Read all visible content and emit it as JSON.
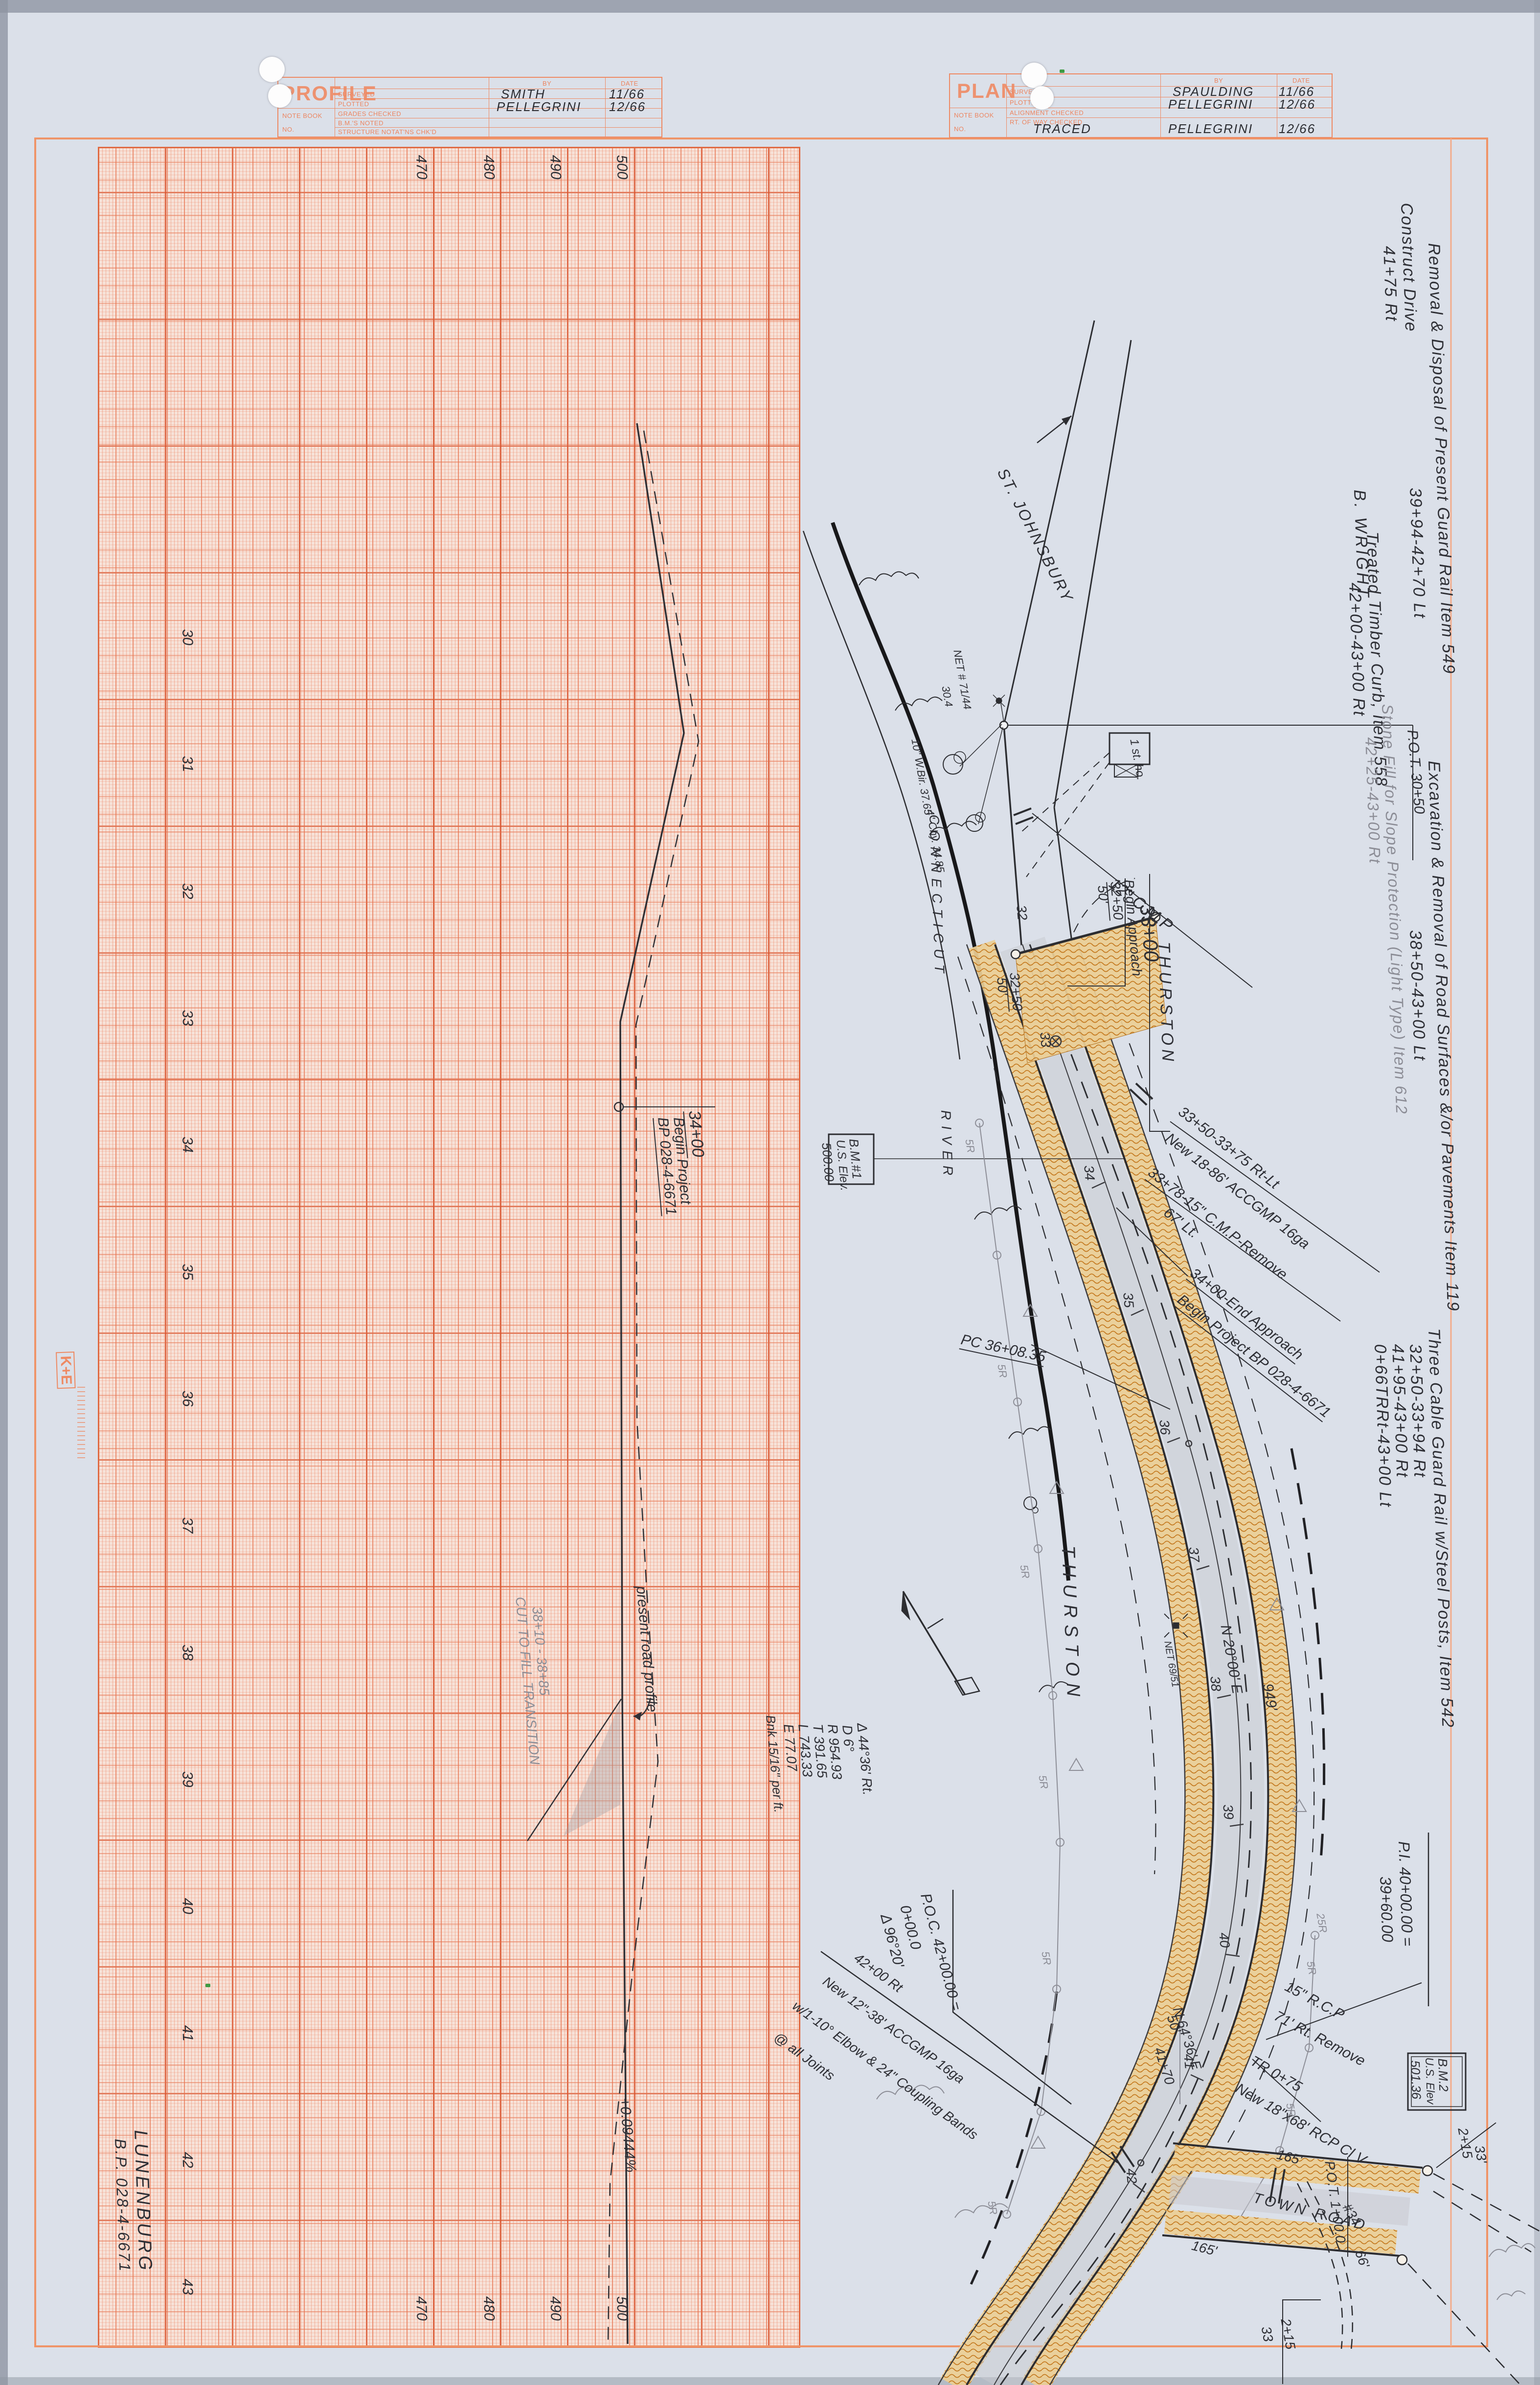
{
  "profile_block": {
    "title": "PROFILE",
    "note_book": "NOTE BOOK",
    "no_label": "NO.",
    "by": "BY",
    "date": "DATE",
    "row1": "SURVEYED",
    "row2": "PLOTTED",
    "row3": "GRADES CHECKED",
    "row4": "B.M.'S NOTED",
    "row5": "STRUCTURE NOTAT'NS CHK'D",
    "surveyed_by": "SMITH",
    "surveyed_date": "11/66",
    "plotted_by": "PELLEGRINI",
    "plotted_date": "12/66"
  },
  "plan_block": {
    "title": "PLAN",
    "note_book": "NOTE BOOK",
    "no_label": "NO.",
    "by": "BY",
    "date": "DATE",
    "row1": "SURVEYED",
    "row2": "PLOTTED",
    "row3": "ALIGNMENT CHECKED",
    "row4": "RT. OF WAY CHECKED",
    "surveyed_by": "SPAULDING",
    "surveyed_date": "11/66",
    "plotted_by": "PELLEGRINI",
    "plotted_date": "12/66",
    "traced_label": "TRACED",
    "traced_by": "PELLEGRINI",
    "traced_date": "12/66"
  },
  "profile": {
    "stations": [
      "30",
      "31",
      "32",
      "33",
      "34",
      "35",
      "36",
      "37",
      "38",
      "39",
      "40",
      "41",
      "42",
      "43"
    ],
    "elevations": [
      "470",
      "480",
      "490",
      "500"
    ],
    "begin_sta": "34+00",
    "begin_l1": "Begin Project",
    "begin_l2": "BP 028-4-6671",
    "cut_fill_l1": "38+10 - 38+85",
    "cut_fill_l2": "CUT TO FILL TRANSITION",
    "present_road": "present road profile",
    "grade": "+0.09444%",
    "town": "LUNENBURG",
    "project": "B.P. 028-4-6671"
  },
  "plan": {
    "st_johnsbury": "ST. JOHNSBURY",
    "b_wright": "B. WRIGHT",
    "pot_3050": "P.O.T. 30+50",
    "cmp12": "12\" C.M.P",
    "pole1": "NET # 71/44",
    "pole1_ht": "30.4",
    "tree1": "10\" W.Bir. 37.65",
    "tree2": "4\" Chy. 34.85",
    "house": "1 st. ho.",
    "thurston": "THURSTON",
    "connecticut": "CONNECTICUT",
    "river": "RIVER",
    "begin_approach": "Begin Approach",
    "approach_sta": "32+50",
    "approach_off": "50'",
    "approach_sta2": "33+00",
    "edge_sta": "32+50",
    "edge_off": "50'",
    "note1_l1": "33+50-33+75 Rt-Lt",
    "note1_l2": "New 18-86' ACCGMP 16ga",
    "note2_l1": "33+78-15\" C.M.P-Remove",
    "note2_l2": "67' Lt.",
    "end_approach_l1": "34+00-End Approach",
    "end_approach_l2": "Begin Project BP 028-4-6671",
    "bm1_l1": "B.M.#1",
    "bm1_l2": "U.S. Elev.",
    "bm1_l3": "500.00",
    "pc": "PC 36+08.35",
    "bearing_main": "N 20°00' E",
    "dist949": "949'",
    "pole2": "NET 69/51",
    "curve_d": "Δ 44°36' Rt.",
    "curve_deg": "D 6°",
    "curve_r": "R 954.93",
    "curve_t": "T 391.65",
    "curve_l": "L 743.33",
    "curve_e": "E 77.07",
    "curve_bnk": "Bnk 15/16\" per ft.",
    "poc_l1": "P.O.C. 42+00.00 =",
    "poc_l2": "0+00.0",
    "poc_l3": "Δ 96°20'",
    "cul42_l1": "42+00 Rt",
    "cul42_l2": "New 12\"-38' ACCGMP 16ga",
    "cul42_l3": "w/1-10° Elbow & 24\" Coupling Bands",
    "cul42_l4": "@ all Joints",
    "rcp_l1": "15\" R.C.P",
    "rcp_l2": "71' Rt. Remove",
    "tr_l1": "TR 0+75",
    "tr_l2": "New 18\"x68' RCP Cl V",
    "pot_100": "P.O.T. 1+00.0",
    "town_road": "TOWN ROAD",
    "town_road_no": "#34",
    "d165": "165'",
    "d66": "66'",
    "flag215": "2+15",
    "flag33": "33'",
    "flag33b": "33",
    "bearing_tr": "N 64°36' E",
    "sta4170": "41+70",
    "off50": "50'",
    "gr5": "5R",
    "gr25": "25R",
    "stations": [
      "32",
      "33",
      "34",
      "35",
      "36",
      "37",
      "38",
      "39",
      "40",
      "41",
      "42"
    ]
  },
  "right_notes": {
    "n1a": "Construct Drive",
    "n1b": "41+75 Rt",
    "n2a": "Removal & Disposal of Present Guard Rail Item 549",
    "n2b": "39+94-42+70 Lt",
    "n3a": "Treated Timber Curb, Item 558",
    "n3b": "42+00-43+00 Rt",
    "n4a": "Excavation & Removal of Road Surfaces &/or Pavements Item 119",
    "n4b": "38+50-43+00 Lt",
    "n5a": "Stone Fill for Slope Protection (Light Type) Item 612",
    "n5b": "42+25-43+00 Rt",
    "n6a": "Three Cable Guard Rail w/Steel Posts, Item 542",
    "n6b": "32+50-33+94 Rt",
    "n6c": "41+95-43+00 Rt",
    "n6d": "0+66TRRt-43+00 Lt",
    "pi1": "P.I. 40+00.00 =",
    "pi2": "39+60.00",
    "bm2_l1": "B.M.2",
    "bm2_l2": "U.S. Elev",
    "bm2_l3": "501.36"
  },
  "stamp": {
    "logo": "K+E"
  }
}
